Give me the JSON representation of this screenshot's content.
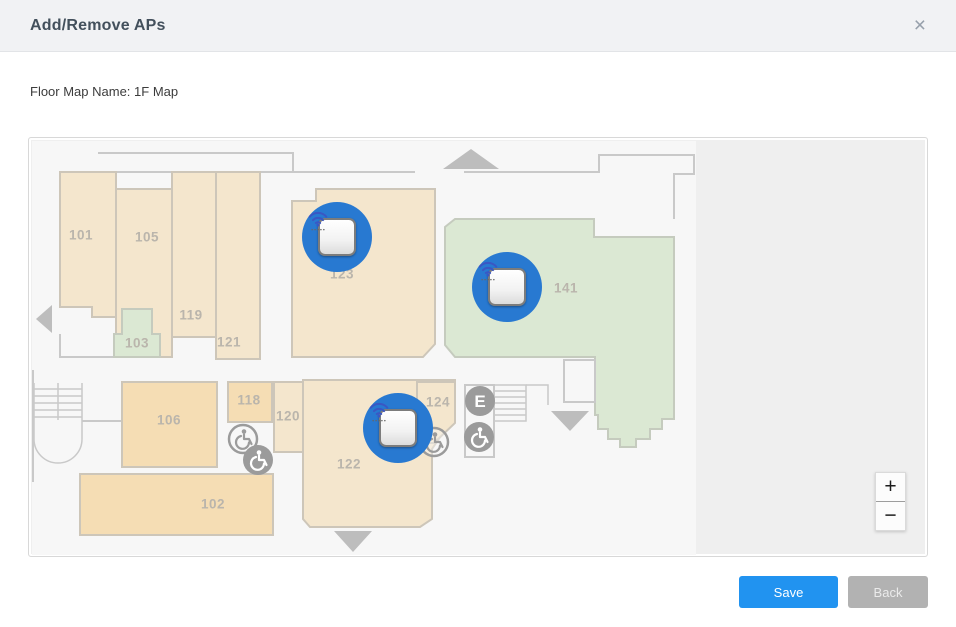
{
  "dialog": {
    "title": "Add/Remove APs",
    "close_icon": "×",
    "floor_map_name": "Floor Map Name: 1F Map"
  },
  "footer": {
    "save_label": "Save",
    "back_label": "Back"
  },
  "map": {
    "zoom_in_label": "+",
    "zoom_out_label": "−",
    "elevator_label": "E",
    "rooms": [
      {
        "label": "101",
        "x": 52,
        "y": 97
      },
      {
        "label": "105",
        "x": 118,
        "y": 99
      },
      {
        "label": "119",
        "x": 162,
        "y": 177
      },
      {
        "label": "103",
        "x": 108,
        "y": 205
      },
      {
        "label": "121",
        "x": 200,
        "y": 204
      },
      {
        "label": "123",
        "x": 313,
        "y": 136
      },
      {
        "label": "141",
        "x": 537,
        "y": 150
      },
      {
        "label": "106",
        "x": 140,
        "y": 282
      },
      {
        "label": "118",
        "x": 220,
        "y": 262
      },
      {
        "label": "120",
        "x": 259,
        "y": 278
      },
      {
        "label": "124",
        "x": 409,
        "y": 264
      },
      {
        "label": "122",
        "x": 320,
        "y": 326
      },
      {
        "label": "102",
        "x": 184,
        "y": 366
      }
    ],
    "aps": [
      {
        "id": "ap-1",
        "room": "123",
        "x": 308,
        "y": 99
      },
      {
        "id": "ap-2",
        "room": "141",
        "x": 478,
        "y": 149
      },
      {
        "id": "ap-3",
        "room": "122",
        "x": 369,
        "y": 290
      }
    ]
  },
  "colors": {
    "accent_blue": "#2193f0",
    "ap_blue": "#2879d1",
    "room_beige_light": "#f4e6cd",
    "room_beige_dark": "#f5ddb4",
    "room_green": "#dbe8d3"
  }
}
